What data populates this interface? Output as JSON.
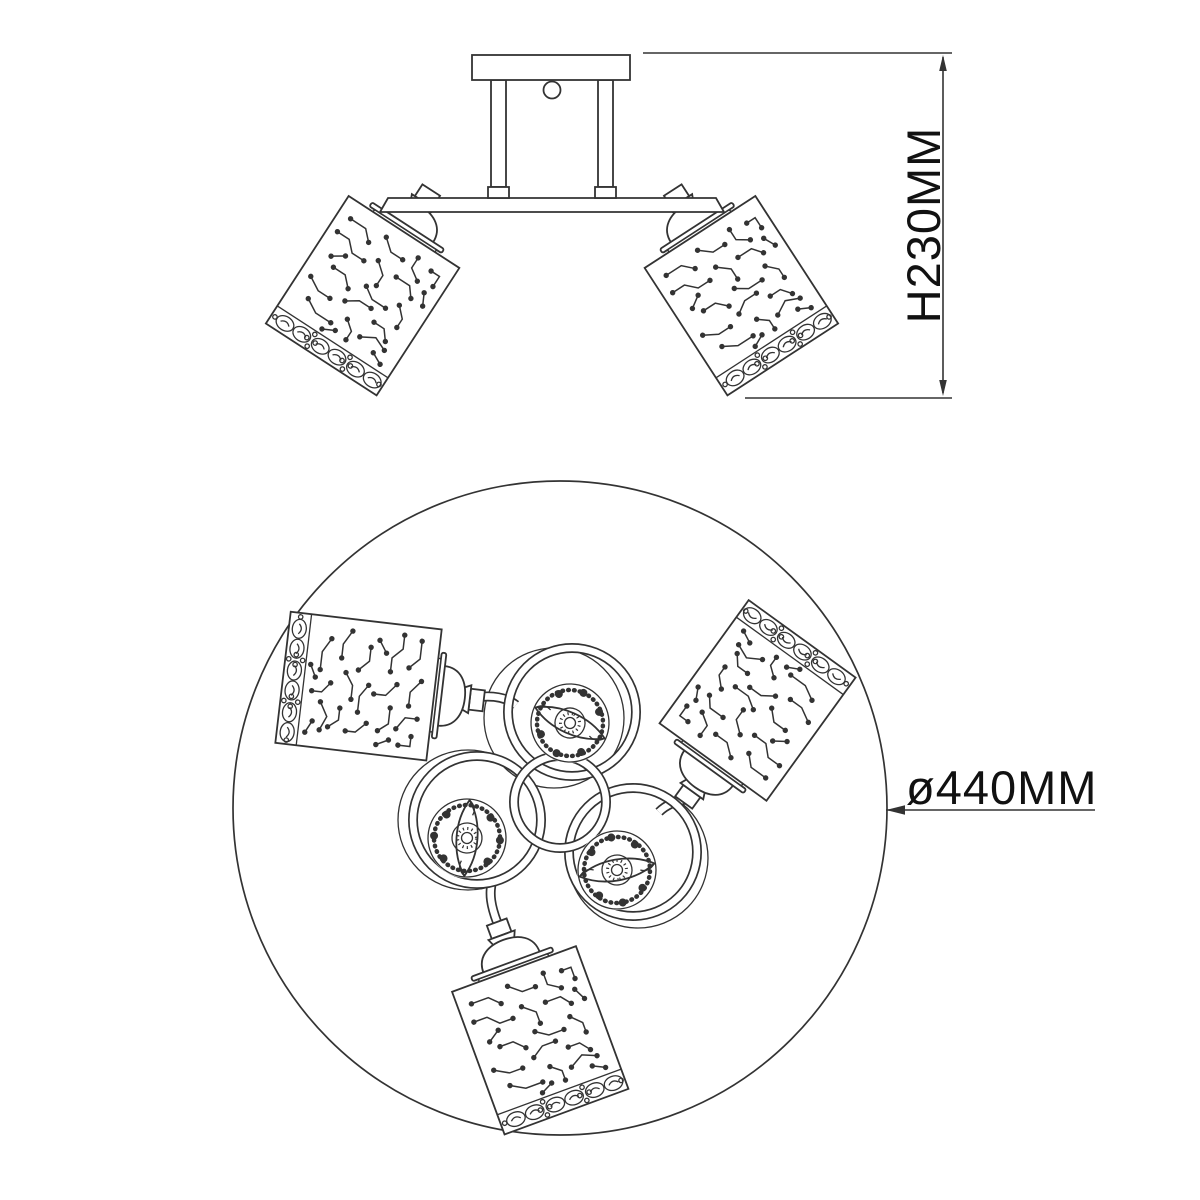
{
  "drawing": {
    "kind": "ceiling light fixture technical drawing",
    "background": "#ffffff"
  },
  "colors": {
    "line": "#333333",
    "text": "#111111",
    "background": "#ffffff"
  },
  "dimensions": {
    "height_label": "H230MM",
    "height_mm": 230,
    "diameter_label": "ø440MM",
    "diameter_mm": 440
  }
}
